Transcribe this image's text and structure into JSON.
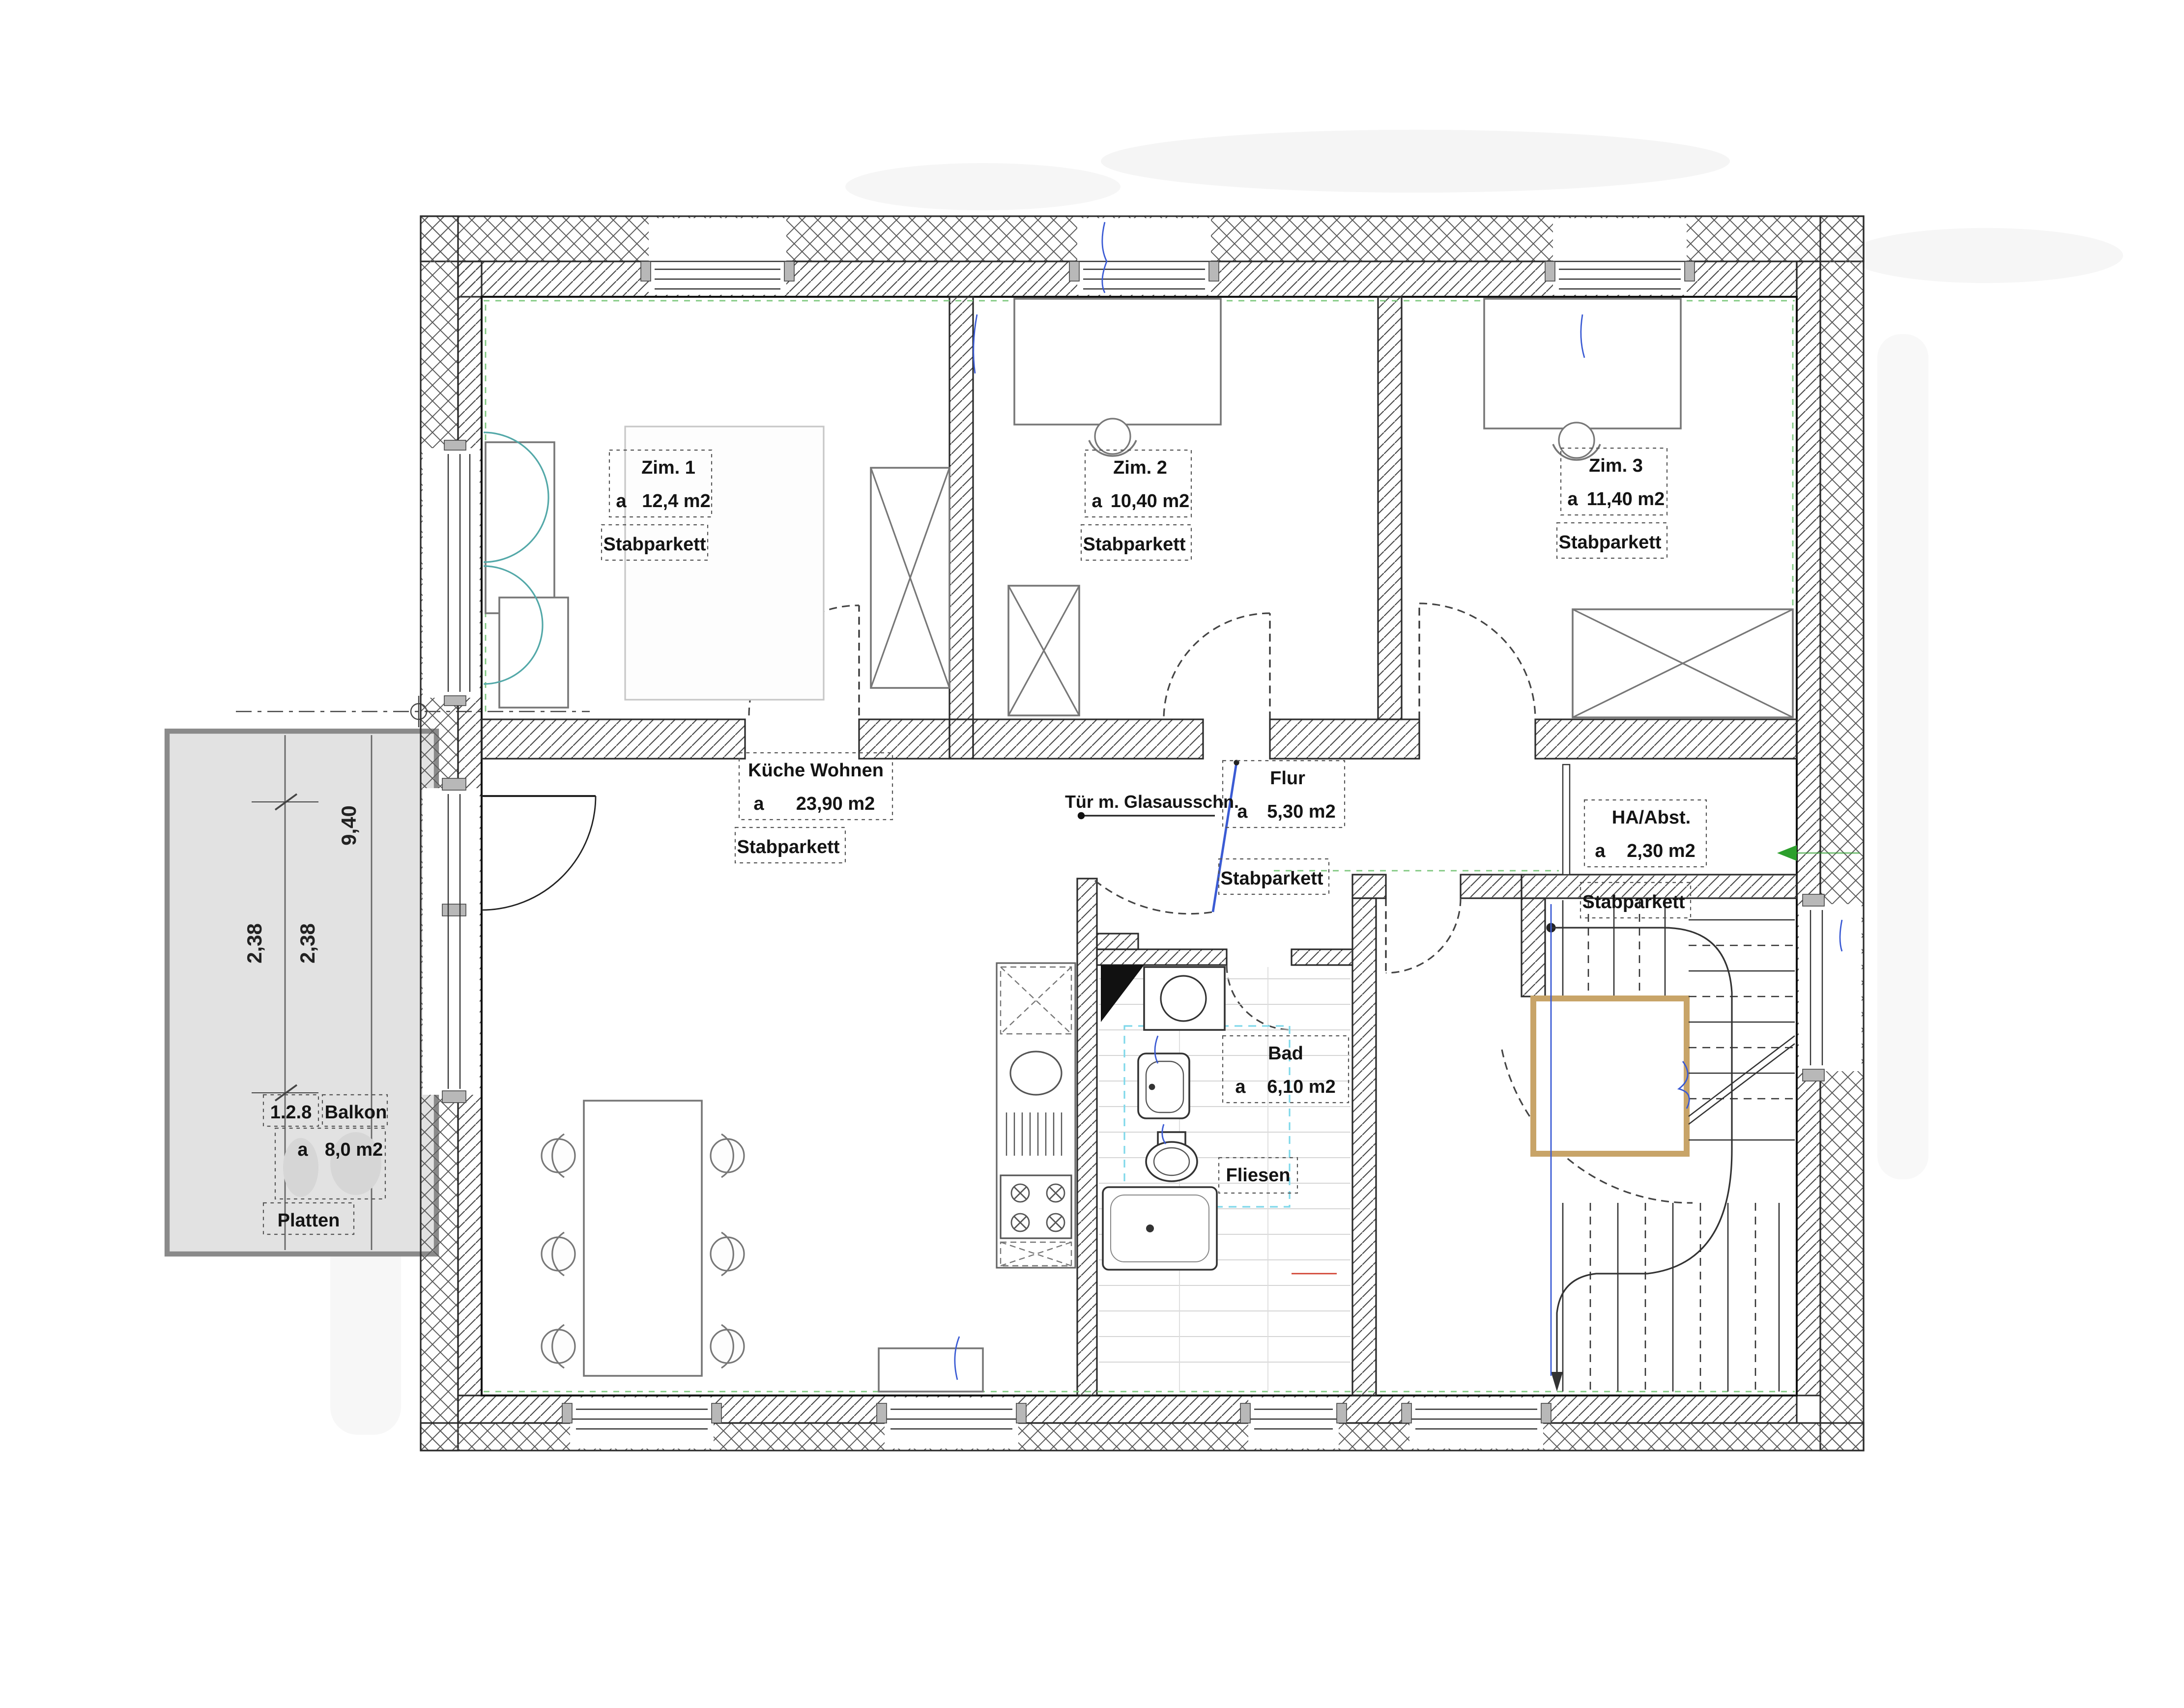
{
  "plan": {
    "rooms": {
      "zim1": {
        "name": "Zim. 1",
        "a": "a",
        "area": "12,4 m2",
        "floor": "Stabparkett"
      },
      "zim2": {
        "name": "Zim. 2",
        "a": "a",
        "area": "10,40 m2",
        "floor": "Stabparkett"
      },
      "zim3": {
        "name": "Zim. 3",
        "a": "a",
        "area": "11,40 m2",
        "floor": "Stabparkett"
      },
      "kueche": {
        "name": "Küche Wohnen",
        "a": "a",
        "area": "23,90 m2",
        "floor": "Stabparkett"
      },
      "flur": {
        "name": "Flur",
        "a": "a",
        "area": "5,30 m2",
        "floor": "Stabparkett"
      },
      "ha": {
        "name": "HA/Abst.",
        "a": "a",
        "area": "2,30 m2",
        "floor": "Stabparkett"
      },
      "bad": {
        "name": "Bad",
        "a": "a",
        "area": "6,10 m2",
        "floor": "Fliesen"
      },
      "balkon": {
        "code": "1.2.8",
        "name": "Balkon",
        "a": "a",
        "area": "8,0 m2",
        "floor": "Platten"
      }
    },
    "annotations": {
      "glass_door_note": "Tür m. Glasausschn."
    },
    "dimensions": {
      "balcony_length": "9,40",
      "balcony_half_a": "2,38",
      "balcony_half_b": "2,38"
    },
    "colors": {
      "balcony_fill": "#e2e2e2",
      "stairwell_frame": "#c8a468",
      "door_leaf_blue": "#3b5bd4",
      "install_green": "#7fc87f"
    }
  }
}
